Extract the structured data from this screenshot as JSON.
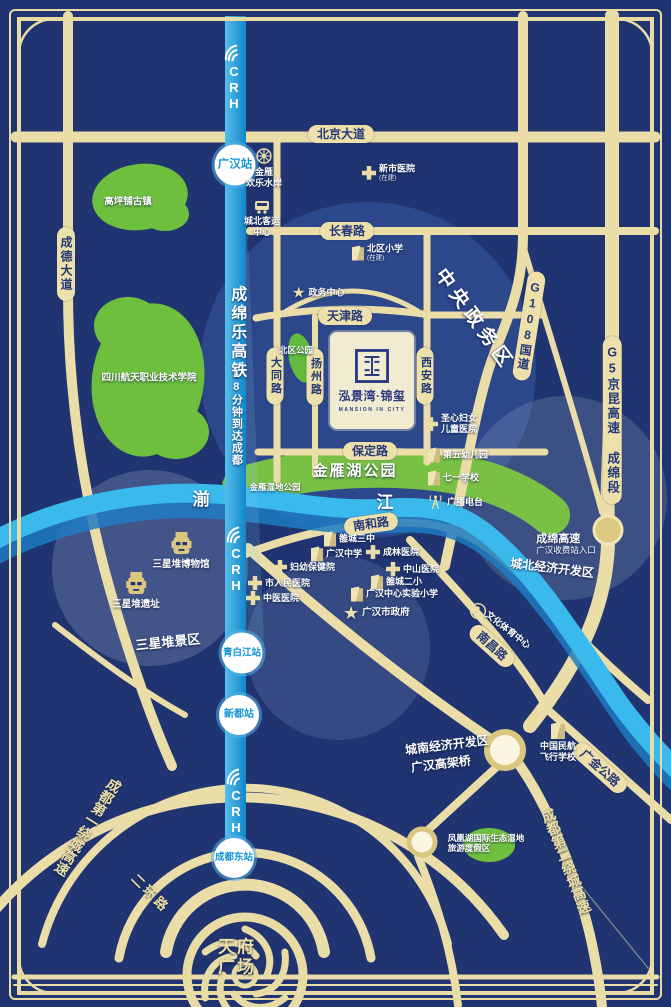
{
  "emblem": {
    "name": "泓景湾·锦玺",
    "en": "MANSION IN CITY"
  },
  "rail": {
    "logo": "CRH",
    "line": "成绵乐高铁",
    "slogan": "18分钟到达成都",
    "st_guanghan": "广汉站",
    "st_qingbaijiang": "青白江站",
    "st_xindu": "新都站",
    "st_chengdudong": "成都东站"
  },
  "pills": {
    "beijing": "北京大道",
    "changchun": "长春路",
    "tianjin": "天津路",
    "baoding": "保定路",
    "nanhe": "南和路",
    "chengde": "成德大道",
    "datong": "大同路",
    "yangzhou": "扬州路",
    "xian": "西安路",
    "g108": "G108国道",
    "g5": "G5京昆高速 成绵段",
    "nanchang": "南昌路",
    "guangjin": "广金公路"
  },
  "areas": {
    "central": "中央政务区",
    "north_dev": "城北经济开发区",
    "south_dev": "城南经济开发区",
    "viaduct": "广汉高架桥",
    "sanxingdui": "三星堆景区",
    "ring1": "成都第一绕城高速",
    "ring2": "成都第二绕城高速",
    "erhuan": "二环路",
    "tianfu1": "天府",
    "tianfu2": "广场",
    "toll_line1": "成绵高速",
    "toll_line2": "广汉收费站入口"
  },
  "river": {
    "c1": "湔",
    "c2": "江"
  },
  "parks": {
    "gaoping": "高坪铺古镇",
    "aerospace": "四川航天职业技术学院",
    "beiqu": "北区公园",
    "jinyan": "金雁湖公园",
    "jinyan_wet": "金雁湿地公园",
    "phoenix1": "凤凰湖国际生态湿地",
    "phoenix2": "旅游度假区"
  },
  "pois": {
    "jinyan_water": {
      "l1": "金雁",
      "l2": "欢乐水岸"
    },
    "chengbei_bus": {
      "l1": "城北客运",
      "l2": "中心"
    },
    "xinshi": {
      "label": "新市医院",
      "note": "(在建)"
    },
    "beiqu_xiaoxue": {
      "label": "北区小学",
      "note": "(在建)"
    },
    "zhengwu": {
      "label": "政务中心"
    },
    "shengxin": {
      "l1": "圣心妇女",
      "l2": "儿童医院"
    },
    "diwu": {
      "label": "第五幼儿园"
    },
    "qiyi": {
      "label": "七一学校"
    },
    "radio": {
      "label": "广播电台"
    },
    "luocheng3": {
      "label": "雒城三中"
    },
    "ghzx": {
      "label": "广汉中学"
    },
    "chenglin": {
      "label": "成林医院"
    },
    "fuyou": {
      "label": "妇幼保健院"
    },
    "zhongshan": {
      "label": "中山医院"
    },
    "renmin": {
      "label": "市人民医院"
    },
    "zhongyi": {
      "label": "中医医院"
    },
    "luocheng2": {
      "label": "雒城二小"
    },
    "shiyan": {
      "label": "广汉中心实验小学"
    },
    "government": {
      "label": "广汉市政府"
    },
    "sxd_museum": {
      "label": "三星堆博物馆"
    },
    "sxd_site": {
      "label": "三星堆遗址"
    },
    "culture": {
      "label": "文化体育中心"
    },
    "aviation": {
      "l1": "中国民航",
      "l2": "飞行学校"
    }
  },
  "colors": {
    "background": "#1f3470",
    "road": "#eadda8",
    "rail_blue": "#1e9ad6",
    "river_blue": "#3ab9ec",
    "park_green": "#6fbf3e",
    "cream_text": "#ecdfa8",
    "station_text": "#1295d6",
    "pill_text": "#233878"
  }
}
